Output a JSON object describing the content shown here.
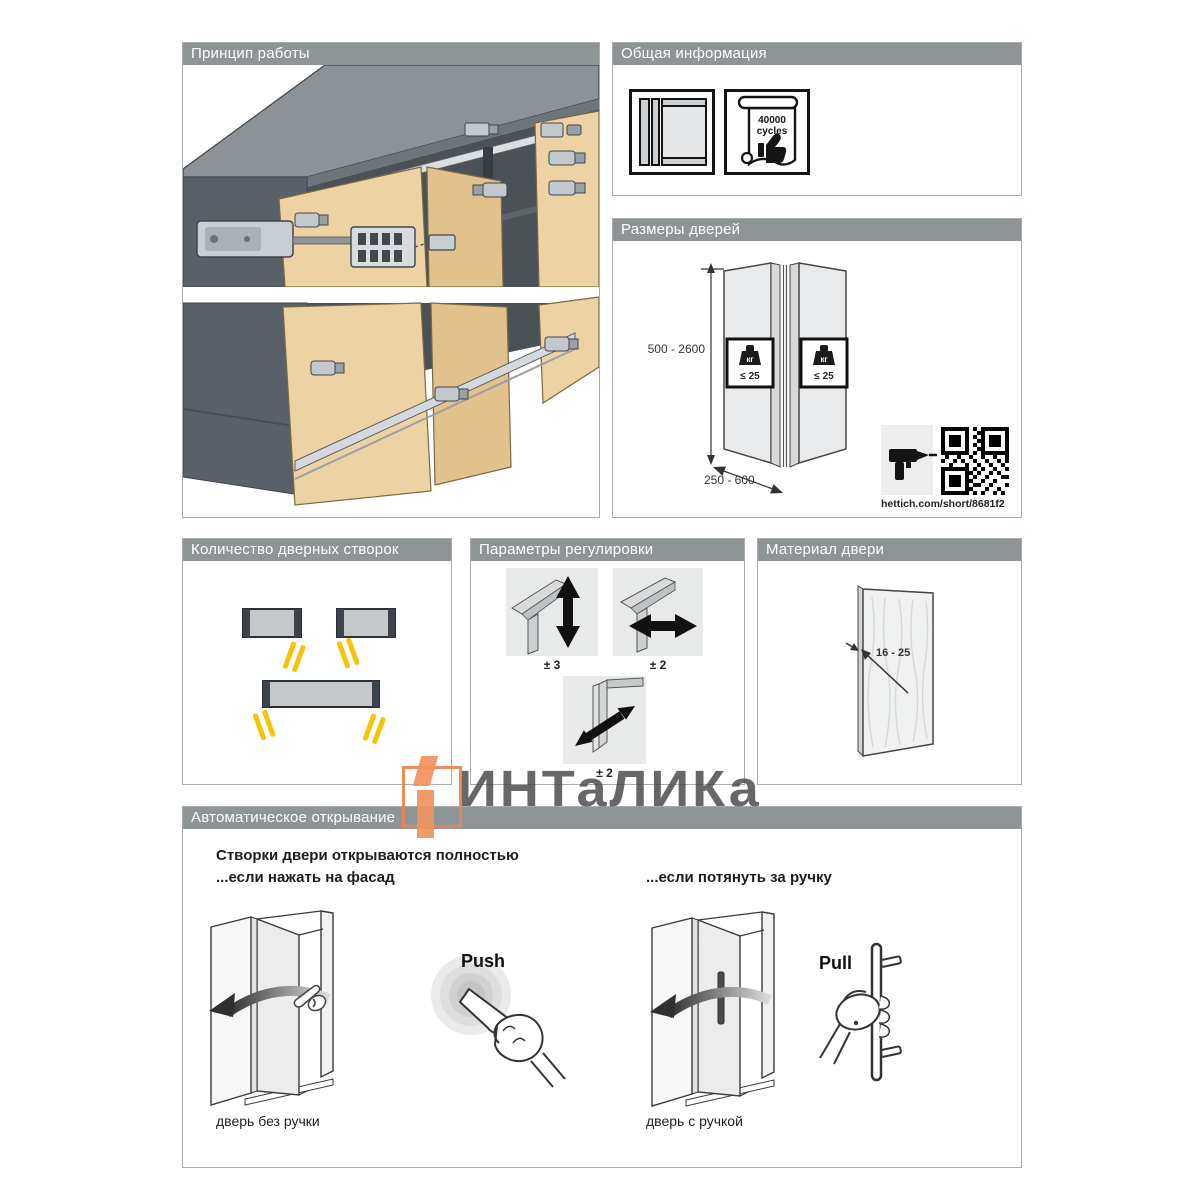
{
  "watermark": {
    "text": "ИНТаЛИКа"
  },
  "colors": {
    "header_gray": "#8f9496",
    "accent_orange": "#f0935e",
    "wood": "#edd2a3",
    "door_yellow": "#f5c40a"
  },
  "panels": {
    "principle": {
      "title": "Принцип работы"
    },
    "general": {
      "title": "Общая информация",
      "cycles_value": "40000",
      "cycles_unit": "cycles"
    },
    "dimensions": {
      "title": "Размеры дверей",
      "height_range": "500 - 2600",
      "width_range": "250 - 600",
      "weight_unit": "кг",
      "weight_limit": "≤ 25",
      "link": "hettich.com/short/8681f2"
    },
    "leaf_count": {
      "title": "Количество дверных створок"
    },
    "adjustment": {
      "title": "Параметры регулировки",
      "vertical": "± 3",
      "horizontal": "± 2",
      "diagonal": "± 2"
    },
    "material": {
      "title": "Материал двери",
      "thickness": "16 - 25"
    },
    "opening": {
      "title": "Автоматическое открывание",
      "headline": "Створки двери открываются полностью",
      "push_condition": "...если нажать на фасад",
      "pull_condition": "...если потянуть за ручку",
      "push_label": "Push",
      "pull_label": "Pull",
      "caption_push": "дверь без ручки",
      "caption_pull": "дверь с ручкой"
    }
  }
}
